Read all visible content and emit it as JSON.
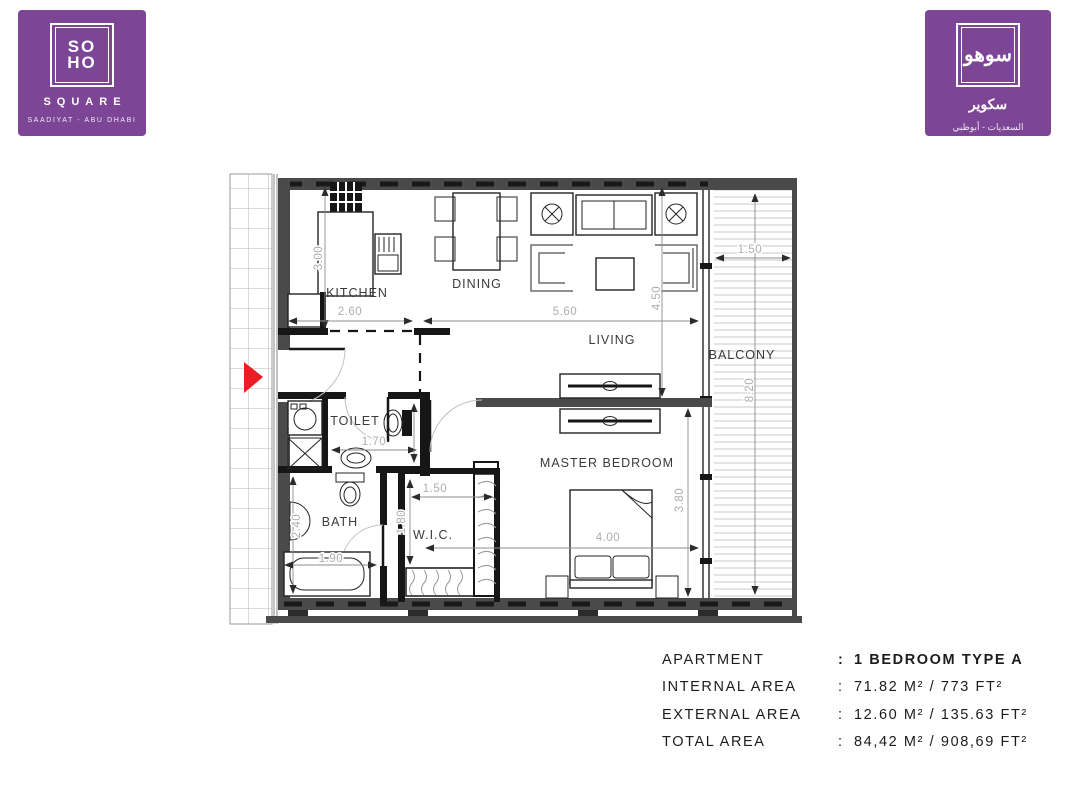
{
  "header": {
    "logo_left": {
      "frame_line1": "SO",
      "frame_line2": "HO",
      "name": "SQUARE",
      "location": "SAADIYAT - ABU DHABI",
      "bg_color": "#7d4596"
    },
    "logo_right": {
      "frame_glyph": "سوهو",
      "name": "سكوير",
      "location": "السعديات - أبوظبي",
      "bg_color": "#7d4596"
    }
  },
  "floor_plan": {
    "entrance_marker_color": "#ec1c24",
    "wall_color": "#4a4a4a",
    "rooms": {
      "kitchen": "KITCHEN",
      "dining": "DINING",
      "living": "LIVING",
      "balcony": "BALCONY",
      "toilet": "TOILET",
      "bath": "BATH",
      "wic": "W.I.C.",
      "master_bedroom": "MASTER BEDROOM"
    },
    "dimensions": {
      "kitchen_depth": "3.00",
      "kitchen_width": "2.60",
      "living_width": "5.60",
      "living_depth": "4.50",
      "balcony_width": "1.50",
      "balcony_length": "8.20",
      "toilet_width": "1.70",
      "bath_depth": "2.40",
      "bath_width": "1.90",
      "wic_width": "1.50",
      "wic_depth": "1.80",
      "bedroom_width": "4.00",
      "bedroom_depth": "3.80"
    }
  },
  "details": {
    "rows": [
      {
        "label": "APARTMENT",
        "separator": ":",
        "value": "1 BEDROOM TYPE A"
      },
      {
        "label": "INTERNAL AREA",
        "separator": ":",
        "value": "71.82 M² / 773 FT²"
      },
      {
        "label": "EXTERNAL AREA",
        "separator": ":",
        "value": "12.60 M² / 135.63 FT²"
      },
      {
        "label": "TOTAL AREA",
        "separator": ":",
        "value": "84,42 M² / 908,69 FT²"
      }
    ]
  }
}
